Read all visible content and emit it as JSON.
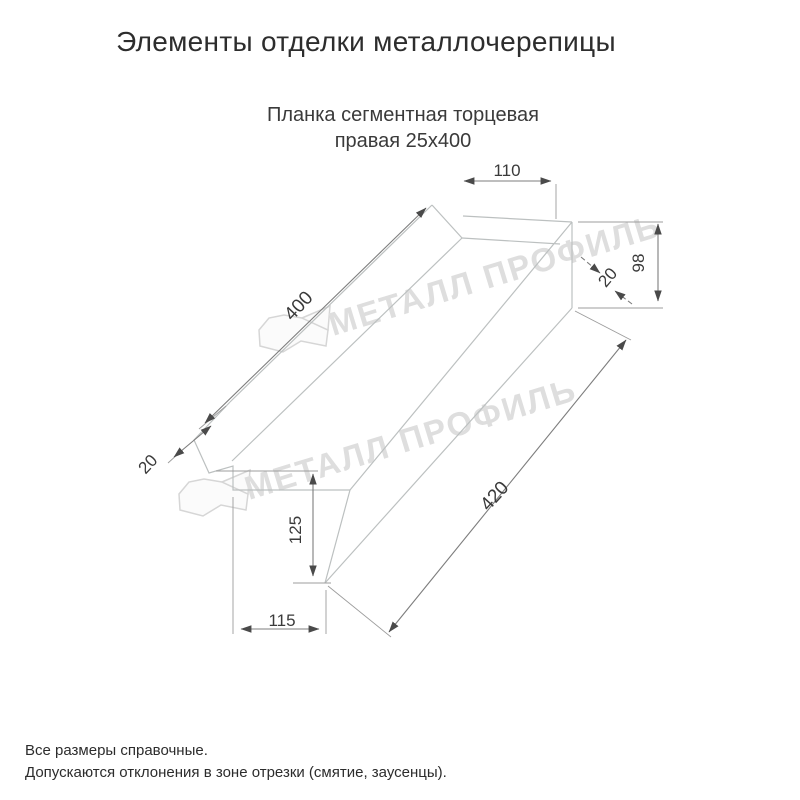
{
  "header": {
    "title": "Элементы отделки металлочерепицы"
  },
  "drawing": {
    "subtitle_line1": "Планка сегментная торцевая",
    "subtitle_line2": "правая 25х400",
    "watermark_text": "МЕТАЛЛ ПРОФИЛЬ",
    "dimensions": {
      "top_flange_width": "110",
      "upper_edge_length": "400",
      "right_end_height": "98",
      "right_hem": "20",
      "left_hem": "20",
      "left_end_height": "125",
      "lower_edge_length": "420",
      "bottom_flange_width": "115"
    }
  },
  "footer": {
    "note1": "Все размеры справочные.",
    "note2": "Допускаются отклонения в зоне отрезки (смятие, заусенцы)."
  },
  "colors": {
    "part_line": "#bcc0c0",
    "dimension_line": "#7d7d7d",
    "dimension_text": "#3a3a3a",
    "watermark": "#dedede",
    "text": "#2d2d2d"
  }
}
